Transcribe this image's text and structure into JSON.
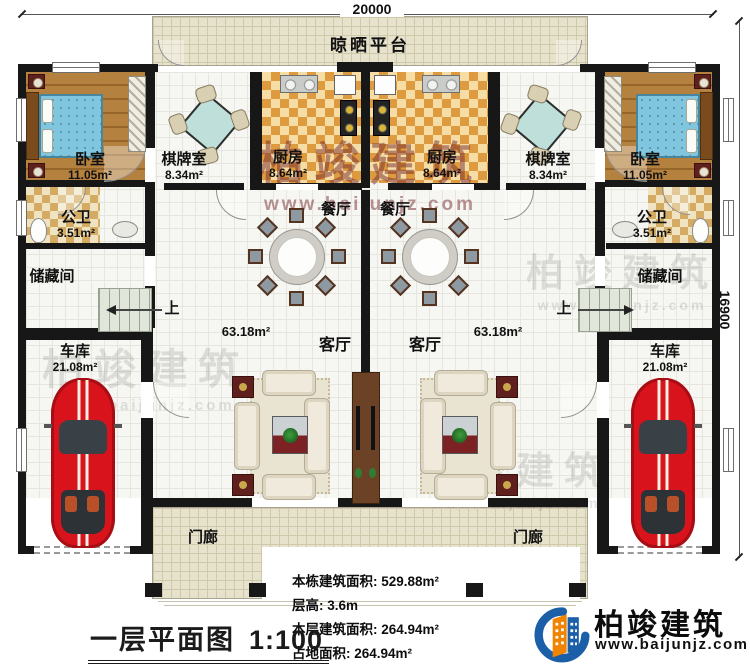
{
  "dimensions": {
    "width": "20000",
    "height": "16900"
  },
  "platform": {
    "label": "晾晒平台"
  },
  "stairs": {
    "up": "上"
  },
  "rooms": {
    "bedroom": {
      "name": "卧室",
      "area": "11.05m²"
    },
    "chess_room": {
      "name": "棋牌室",
      "area": "8.34m²"
    },
    "kitchen": {
      "name": "厨房",
      "area": "8.64m²"
    },
    "bathroom": {
      "name": "公卫",
      "area": "3.51m²"
    },
    "storage": {
      "name": "储藏间"
    },
    "dining": {
      "name": "餐厅"
    },
    "living": {
      "name": "客厅",
      "area": "63.18m²"
    },
    "garage": {
      "name": "车库",
      "area": "21.08m²"
    },
    "porch": {
      "name": "门廊"
    }
  },
  "info": {
    "building_total_area": "本栋建筑面积: 529.88m²",
    "floor_height": "层高: 3.6m",
    "floor_area": "本层建筑面积: 264.94m²",
    "footprint_area": "占地面积: 264.94m²"
  },
  "title": {
    "text": "一层平面图",
    "scale": "1:100"
  },
  "brand": {
    "name": "柏竣建筑",
    "url": "www.baijunjz.com"
  },
  "watermark": {
    "text": "柏竣建筑",
    "url": "www.baijunjz.com"
  },
  "colors": {
    "wall": "#171717",
    "wood_floor": "#a9742f",
    "bed_blue": "#7fc6de",
    "kitchen_checker": "#dd9a3f",
    "car_red": "#d8131b",
    "platform_tile": "#e7e2cc",
    "brand_blue": "#1a5fa8",
    "brand_orange": "#f08300",
    "watermark_red": "#7d2a30"
  }
}
